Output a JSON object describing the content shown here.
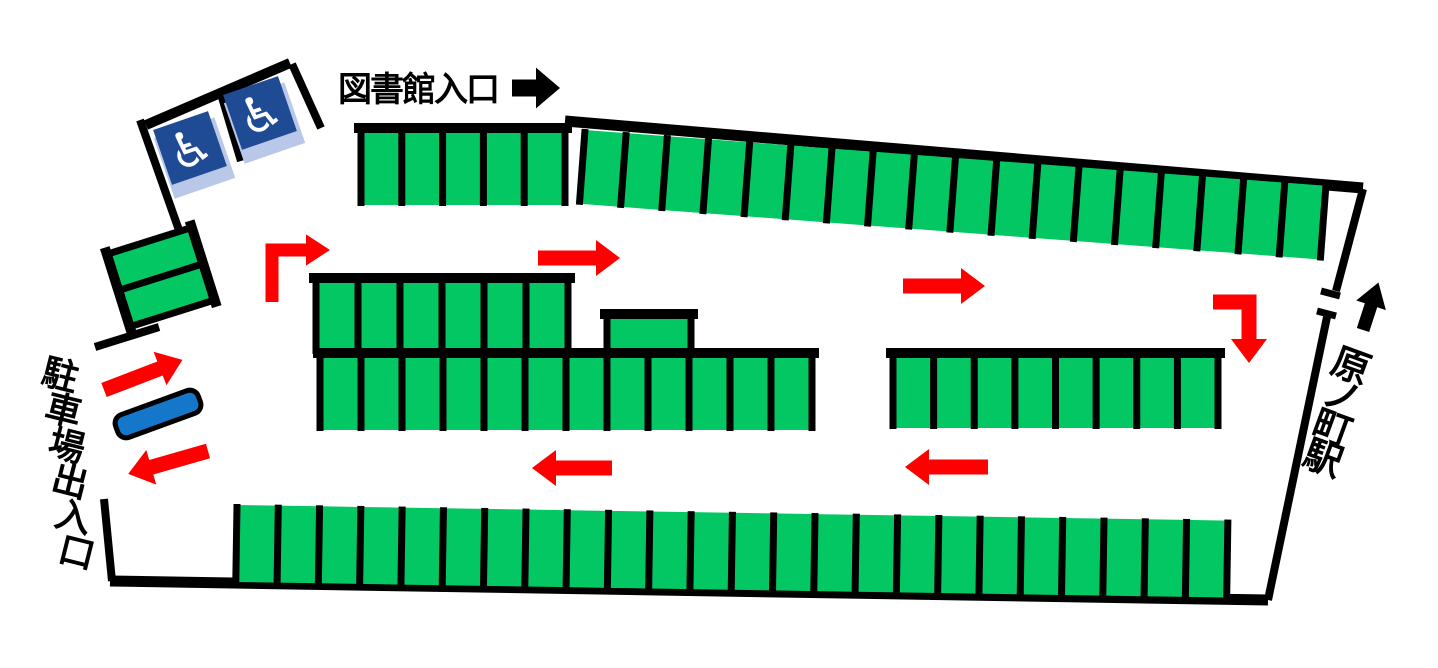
{
  "labels": {
    "library_entrance": "図書館入口",
    "parking_gate": "駐車場出入口",
    "station": "原ノ町駅"
  },
  "icons": {
    "wheelchair": "♿"
  },
  "colors": {
    "space_green": "#03C763",
    "arrow_red": "#FF0000",
    "arrow_black": "#000000",
    "sign_blue": "#1F4B94",
    "sign_shadow_blue": "#B9C8E9",
    "island_blue": "#1577C9",
    "line_black": "#000000"
  },
  "accessible_spaces": {
    "count": 2
  },
  "parking_rows": [
    {
      "name": "row-library-front",
      "x": 361,
      "y": 133,
      "len": 204,
      "h": 72,
      "count": 5,
      "angle": 0,
      "walls": "top"
    },
    {
      "name": "row-top-long",
      "x": 585,
      "y": 130,
      "len": 743,
      "h": 74,
      "count": 18,
      "angle": 4.3,
      "walls": ""
    },
    {
      "name": "row-mid-upper",
      "x": 316,
      "y": 283,
      "len": 252,
      "h": 70,
      "count": 6,
      "angle": 0,
      "walls": "top"
    },
    {
      "name": "row-mid-single",
      "x": 607,
      "y": 319,
      "len": 84,
      "h": 39,
      "count": 1,
      "angle": 0,
      "walls": "top"
    },
    {
      "name": "row-mid-lower",
      "x": 320,
      "y": 358,
      "len": 492,
      "h": 72,
      "count": 12,
      "angle": 0,
      "walls": "top"
    },
    {
      "name": "row-mid-right",
      "x": 893,
      "y": 358,
      "len": 325,
      "h": 70,
      "count": 8,
      "angle": 0,
      "walls": "top"
    },
    {
      "name": "row-bottom-long",
      "x": 237,
      "y": 505,
      "len": 991,
      "h": 77,
      "count": 24,
      "angle": 0.9,
      "walls": ""
    },
    {
      "name": "row-left-tilted",
      "x": 187,
      "y": 229,
      "len": 76,
      "h": 79,
      "count": 2,
      "angle": 72.5,
      "walls": "top bottom"
    }
  ],
  "boundary_walls": [
    [
      565,
      121,
      1363,
      188,
      11
    ],
    [
      1363,
      189,
      1336,
      291,
      8
    ],
    [
      1321,
      291,
      1340,
      296,
      7
    ],
    [
      1317,
      311,
      1336,
      316,
      7
    ],
    [
      1327,
      317,
      1268,
      600,
      8
    ],
    [
      110,
      581,
      1268,
      600,
      11
    ],
    [
      104,
      499,
      112,
      581,
      8
    ],
    [
      95,
      347,
      159,
      327,
      8
    ],
    [
      140,
      120,
      180,
      233,
      8
    ],
    [
      290,
      63,
      146,
      125,
      10
    ],
    [
      292,
      64,
      321,
      128,
      8
    ],
    [
      221,
      94,
      241,
      161,
      8
    ]
  ],
  "arrows": [
    {
      "name": "library-entrance-arrow",
      "type": "straight",
      "x": 512,
      "y": 88,
      "angle": 0,
      "len": 48,
      "t": 17,
      "color": "#000000"
    },
    {
      "name": "flow-up-right-bend-arrow",
      "type": "bent",
      "points": [
        [
          272,
          302
        ],
        [
          272,
          250
        ],
        [
          306,
          250
        ]
      ],
      "head_angle": 0,
      "t": 13,
      "color": "#FF0000"
    },
    {
      "name": "flow-right-arrow-upper-left",
      "type": "straight",
      "x": 538,
      "y": 258,
      "angle": 0,
      "len": 82,
      "t": 15,
      "color": "#FF0000"
    },
    {
      "name": "flow-right-arrow-upper-right",
      "type": "straight",
      "x": 903,
      "y": 286,
      "angle": 0,
      "len": 82,
      "t": 15,
      "color": "#FF0000"
    },
    {
      "name": "flow-right-down-bend-arrow",
      "type": "bent",
      "points": [
        [
          1213,
          302
        ],
        [
          1249,
          302
        ],
        [
          1249,
          339
        ]
      ],
      "head_angle": 90,
      "t": 15,
      "color": "#FF0000"
    },
    {
      "name": "flow-left-arrow-lower-mid",
      "type": "straight",
      "x": 612,
      "y": 468,
      "angle": 180,
      "len": 80,
      "t": 15,
      "color": "#FF0000"
    },
    {
      "name": "flow-left-arrow-lower-right",
      "type": "straight",
      "x": 988,
      "y": 467,
      "angle": 180,
      "len": 83,
      "t": 15,
      "color": "#FF0000"
    },
    {
      "name": "gate-in-arrow",
      "type": "straight",
      "x": 104,
      "y": 390,
      "angle": -21,
      "len": 84,
      "t": 15,
      "color": "#FF0000"
    },
    {
      "name": "gate-out-arrow",
      "type": "straight",
      "x": 208,
      "y": 451,
      "angle": 164,
      "len": 83,
      "t": 15,
      "color": "#FF0000"
    },
    {
      "name": "station-direction-arrow",
      "type": "straight",
      "x": 1363,
      "y": 330,
      "angle": -72,
      "len": 50,
      "t": 13,
      "color": "#000000"
    }
  ],
  "vertical_labels": [
    {
      "name": "parking-gate-label",
      "bind": "parking_gate",
      "x": 60,
      "y": 376,
      "step_x": 3.3,
      "step_y": 35.5,
      "rotate": 14,
      "size": 36
    },
    {
      "name": "station-label",
      "bind": "station",
      "x": 1351,
      "y": 366,
      "step_x": -9.3,
      "step_y": 30.8,
      "rotate": 20,
      "size": 38
    }
  ]
}
